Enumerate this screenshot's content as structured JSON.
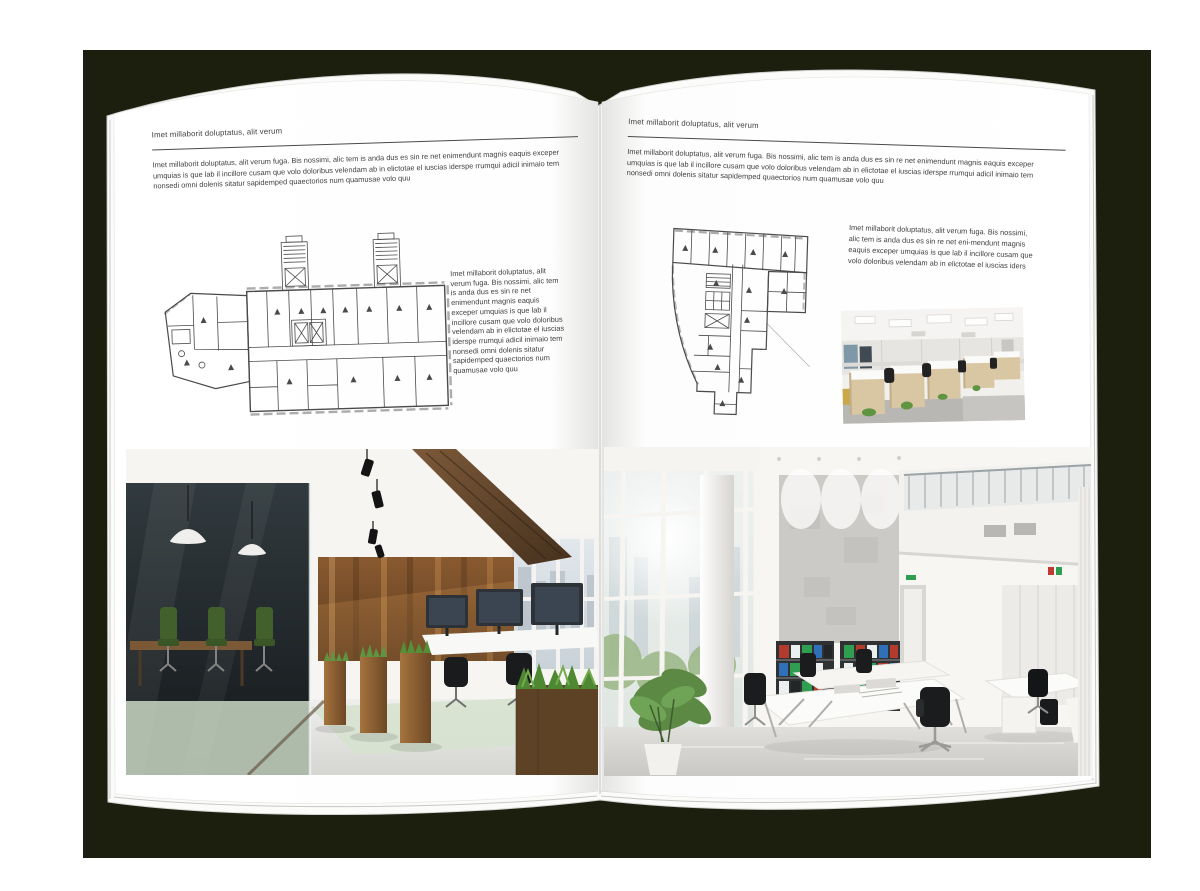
{
  "colors": {
    "backdrop_color": "#1c1e0e",
    "page_color": "#ffffff",
    "text_color": "#3e3e3e",
    "rule_color": "#4a4a4a"
  },
  "left_page": {
    "header": "Imet millaborit doluptatus, alit verum",
    "intro": "Imet millaborit doluptatus, alit verum fuga. Bis nossimi, alic tem is anda dus es sin re net enimendunt magnis eaquis exceper umquias is que lab il incillore cusam que volo doloribus velendam ab in elictotae el iuscias iderspe rrumqui adicil inimaio tem nonsedi omni dolenis sitatur sapidemped quaectorios num quamusae volo quu",
    "caption": "Imet millaborit doluptatus, alit verum fuga. Bis nossimi, alic tem is anda dus es sin re net enimendunt magnis eaquis exceper umquias is que lab il incillore cusam que volo doloribus velendam ab in elictotae el iuscias iderspe rrumqui adicil inimaio tem nonsedi omni dolenis sitatur sapidemped quaectorios num quamusae volo quu"
  },
  "right_page": {
    "header": "Imet millaborit doluptatus, alit verum",
    "intro": "Imet millaborit doluptatus, alit verum fuga. Bis nossimi, alic tem is anda dus es sin re net enimendunt magnis eaquis exceper umquias is que lab il incillore cusam que volo doloribus velendam ab in elictotae el iuscias iderspe rrumqui adicil inimaio tem nonsedi omni dolenis sitatur sapidemped quaectorios num quamusae volo quu",
    "caption": "Imet millaborit doluptatus, alit verum fuga. Bis nossimi, alic tem is anda dus es sin re net eni-mendunt magnis eaquis exceper umquias is que lab il incillore cusam que volo doloribus velendam ab in elictotae el iuscias iders"
  }
}
